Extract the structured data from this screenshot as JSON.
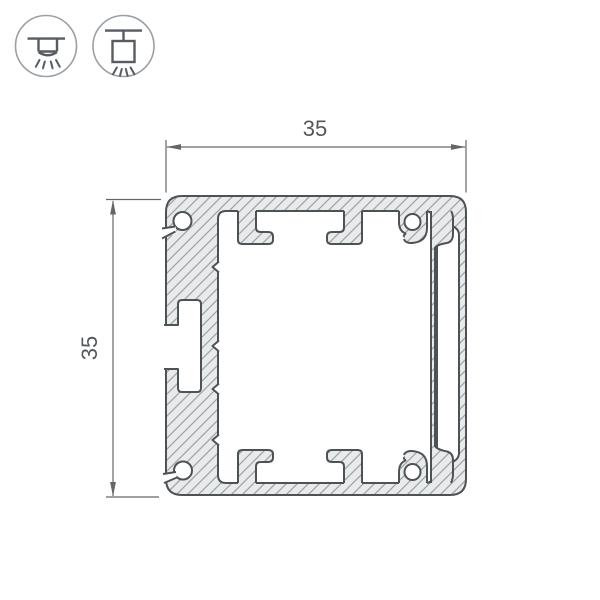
{
  "dimensions": {
    "width": "35",
    "height": "35"
  },
  "icons": [
    {
      "name": "surface-mount-icon"
    },
    {
      "name": "pendant-mount-icon"
    }
  ],
  "colors": {
    "outline": "#4d5256",
    "hatch_fill": "#e9ebeb",
    "hatch_line": "#9aa2a7",
    "dimension": "#63676a",
    "dimension_text": "#54585b",
    "icon_stroke": "#565c61",
    "icon_circle": "#9aa0a4"
  }
}
